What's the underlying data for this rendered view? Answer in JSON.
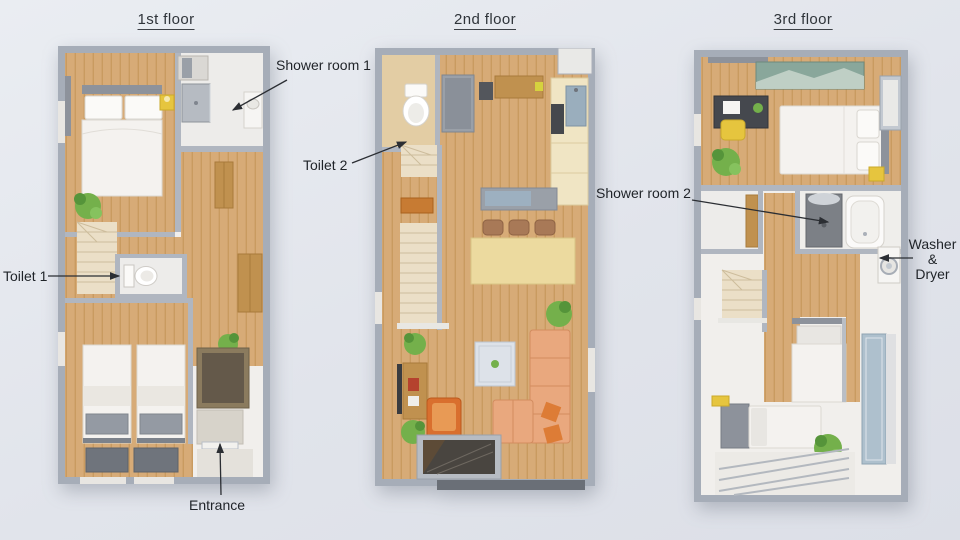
{
  "page": {
    "description": "Three-storey apartment floor plan overview"
  },
  "floors": [
    {
      "title": "1st floor"
    },
    {
      "title": "2nd floor"
    },
    {
      "title": "3rd floor"
    }
  ],
  "annotations": {
    "shower_room_1": "Shower room 1",
    "toilet_2": "Toilet 2",
    "toilet_1": "Toilet 1",
    "entrance": "Entrance",
    "shower_room_2": "Shower room 2",
    "washer_dryer": [
      "Washer",
      "&",
      "Dryer"
    ]
  },
  "colors": {
    "background": "#e3e6ec",
    "outer_wall": "#a6adb8",
    "inner_wall": "#b0b6c0",
    "wood_floor": "#d7ab77",
    "stairs": "#ebdfc7",
    "plant_green": "#74b04b",
    "accent_yellow": "#e6c53e",
    "sofa_salmon": "#e9a87e",
    "cushion_orange": "#dd7c36",
    "label_text": "#1f2328"
  }
}
